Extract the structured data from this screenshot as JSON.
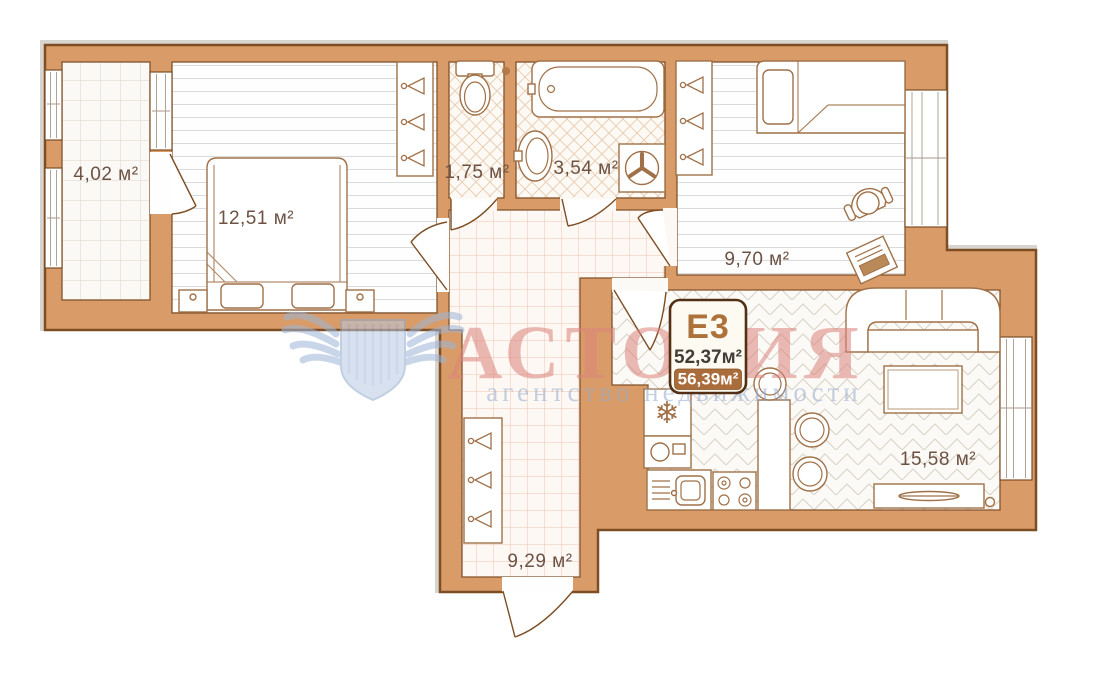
{
  "unit_badge": {
    "code": "E3",
    "area_living": "52,37м²",
    "area_total": "56,39м²"
  },
  "rooms": {
    "balcony": {
      "area_label": "4,02 м²"
    },
    "bedroom_main": {
      "area_label": "12,51 м²"
    },
    "wc": {
      "area_label": "1,75 м²"
    },
    "bathroom": {
      "area_label": "3,54 м²"
    },
    "bedroom_second": {
      "area_label": "9,70 м²"
    },
    "kitchen_living": {
      "area_label": "15,58 м²"
    },
    "hallway": {
      "area_label": "9,29 м²"
    }
  },
  "watermark": {
    "brand": "АСТОРИЯ",
    "tagline": "агентство недвижимости"
  },
  "icons": {
    "fridge_icon": "❄"
  },
  "colors": {
    "wall_fill": "#d99c68",
    "wall_outline": "#7d4e24",
    "badge_brown": "#aa6c3a",
    "label_text": "#6d5244",
    "watermark_pink": "#db837b",
    "watermark_blue": "#93abce"
  }
}
